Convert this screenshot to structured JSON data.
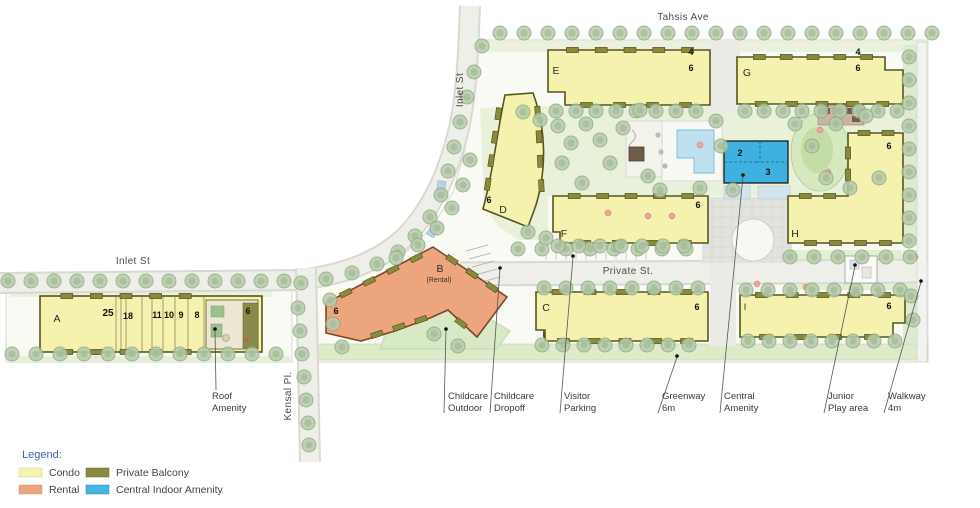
{
  "streets": {
    "tahsis": "Tahsis Ave",
    "inlet_top": "Inlet St",
    "inlet_left": "Inlet St",
    "kensal": "Kensal Pl.",
    "private": "Private St."
  },
  "buildings": {
    "a": {
      "label": "A",
      "heights": {
        "h25": "25",
        "h18": "18",
        "h11": "11",
        "h10": "10",
        "h9": "9",
        "h8": "8",
        "h6": "6"
      }
    },
    "b": {
      "label": "B",
      "sub": "(Rental)",
      "h6": "6"
    },
    "c": {
      "label": "C",
      "h6": "6"
    },
    "d": {
      "label": "D",
      "h6": "6"
    },
    "e": {
      "label": "E",
      "h4": "4",
      "h6": "6"
    },
    "f": {
      "label": "F",
      "h6": "6"
    },
    "g": {
      "label": "G",
      "h4": "4",
      "h6": "6"
    },
    "h": {
      "label": "H",
      "h6": "6"
    },
    "i": {
      "label": "I",
      "h6": "6"
    },
    "amenity": {
      "n2": "2",
      "n3": "3"
    }
  },
  "callouts": {
    "roof": {
      "line1": "Roof",
      "line2": "Amenity"
    },
    "childcare_outdoor": {
      "line1": "Childcare",
      "line2": "Outdoor"
    },
    "childcare_dropoff": {
      "line1": "Childcare",
      "line2": "Dropoff"
    },
    "visitor_parking": {
      "line1": "Visitor",
      "line2": "Parking"
    },
    "greenway": {
      "line1": "Greenway",
      "line2": "6m"
    },
    "central_amenity": {
      "line1": "Central",
      "line2": "Amenity"
    },
    "junior_play": {
      "line1": "Junior",
      "line2": "Play area"
    },
    "walkway": {
      "line1": "Walkway",
      "line2": "4m"
    }
  },
  "legend": {
    "title": "Legend:",
    "items": [
      {
        "label": "Condo",
        "color": "#f4f2ae"
      },
      {
        "label": "Rental",
        "color": "#eda57d"
      },
      {
        "label": "Private Balcony",
        "color": "#8a8a3e"
      },
      {
        "label": "Central Indoor Amenity",
        "color": "#45b5e6"
      }
    ]
  },
  "colors": {
    "condo": "#f4f2ae",
    "rental": "#eda57d",
    "balcony": "#8a8a3e",
    "amenity_blue": "#3fb0e0",
    "building_outline": "#55551e",
    "tree_fill": "#b7cbab",
    "tree_stroke": "#90a886"
  }
}
